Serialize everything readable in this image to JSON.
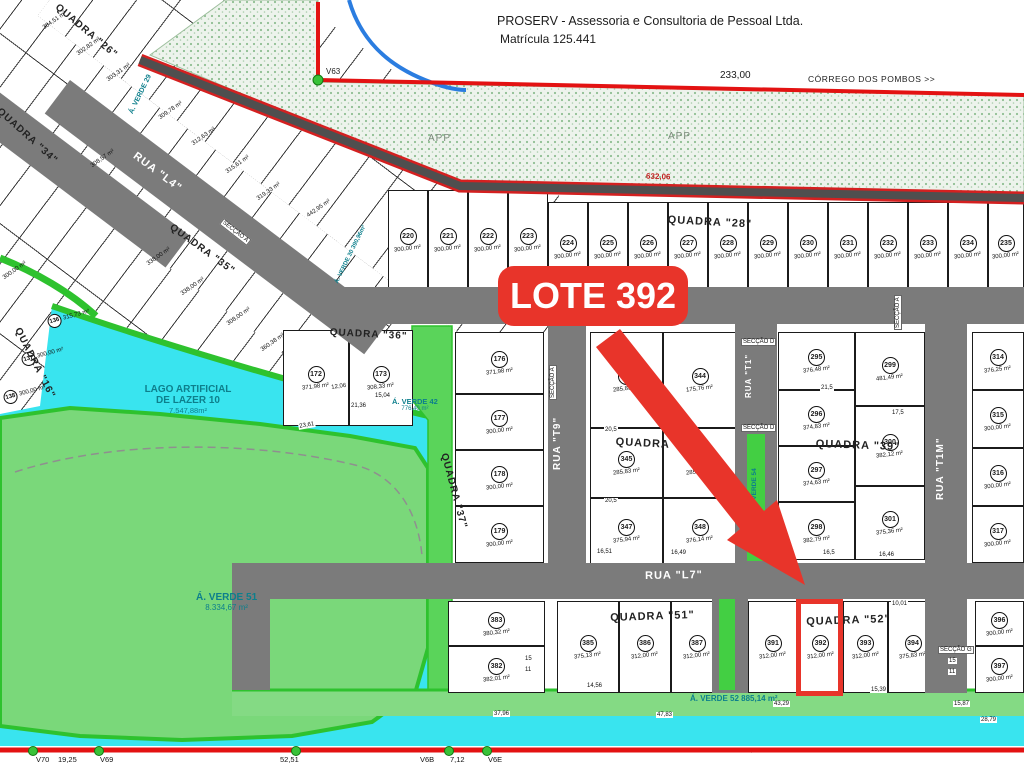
{
  "header": {
    "company_line1": "PROSERV - Assessoria e Consultoria de Pessoal Ltda.",
    "company_line2": "Matrícula 125.441",
    "dim_top": "233,00",
    "stream_label": "CÓRREGO DOS POMBOS >>",
    "vertex_label": "V63",
    "road_dim": "632,06",
    "app_label_left": "APP",
    "app_label_right": "APP"
  },
  "highlight": {
    "badge": "LOTE 392"
  },
  "colors": {
    "water": "#39e4ef",
    "green_area": "#7ad87a",
    "green_strip": "#43cf43",
    "street": "#7b7b7b",
    "boundary_red": "#e31212",
    "highlight_red": "#e8342a",
    "teal_text": "#0d7f8c"
  },
  "lake": {
    "line1": "LAGO ARTIFICIAL",
    "line2": "DE LAZER 10",
    "area": "7.547,88m²"
  },
  "greens": [
    {
      "text": "Á. VERDE 51",
      "sub": "8.334,67 m²",
      "x": 196,
      "y": 592,
      "r": 0,
      "size": 10
    },
    {
      "text": "Á. VERDE 42",
      "sub": "776,40 m²",
      "x": 392,
      "y": 397,
      "r": 0,
      "size": 7.5
    },
    {
      "text": "Á. VERDE 52   885,14 m²",
      "sub": "",
      "x": 690,
      "y": 694,
      "r": 0,
      "size": 8
    },
    {
      "text": "Á. VERDE 54",
      "sub": "",
      "x": 751,
      "y": 508,
      "r": -90,
      "size": 6.5
    },
    {
      "text": "Á. VERDE 29",
      "sub": "",
      "x": 128,
      "y": 112,
      "r": -64,
      "size": 7
    },
    {
      "text": "Á. VERDE 30 390,96m²",
      "sub": "",
      "x": 334,
      "y": 282,
      "r": -64,
      "size": 6
    }
  ],
  "ruas": [
    {
      "label": "RUA \"L4\"",
      "x": 138,
      "y": 150,
      "r": 37,
      "size": 11
    },
    {
      "label": "RUA \"L4\"",
      "x": 618,
      "y": 294,
      "r": 0,
      "size": 11
    },
    {
      "label": "RUA \"L7\"",
      "x": 645,
      "y": 570,
      "r": -1,
      "size": 11
    },
    {
      "label": "RUA \"T9\"",
      "x": 552,
      "y": 470,
      "r": -90,
      "size": 10
    },
    {
      "label": "RUA \"T1\"",
      "x": 744,
      "y": 398,
      "r": -90,
      "size": 8
    },
    {
      "label": "RUA \"T1M\"",
      "x": 935,
      "y": 500,
      "r": -90,
      "size": 10
    }
  ],
  "quadras": [
    {
      "label": "QUADRA \"26\"",
      "x": 60,
      "y": 2,
      "r": 40,
      "size": 10
    },
    {
      "label": "QUADRA \"34\"",
      "x": 2,
      "y": 106,
      "r": 42,
      "size": 10
    },
    {
      "label": "QUADRA \"16\"",
      "x": 22,
      "y": 326,
      "r": 63,
      "size": 10
    },
    {
      "label": "QUADRA \"35\"",
      "x": 174,
      "y": 222,
      "r": 36,
      "size": 10
    },
    {
      "label": "QUADRA \"36\"",
      "x": 330,
      "y": 327,
      "r": 3,
      "size": 10
    },
    {
      "label": "QUADRA \"37\"",
      "x": 449,
      "y": 452,
      "r": 75,
      "size": 10
    },
    {
      "label": "QUADRA \"28\"",
      "x": 668,
      "y": 214,
      "r": 3,
      "size": 11
    },
    {
      "label": "QUADRA",
      "x": 616,
      "y": 436,
      "r": 3,
      "size": 11
    },
    {
      "label": "QUADRA \"39\"",
      "x": 816,
      "y": 438,
      "r": 2,
      "size": 11
    },
    {
      "label": "QUADRA \"51\"",
      "x": 610,
      "y": 612,
      "r": -2,
      "size": 11
    },
    {
      "label": "QUADRA \"52\"",
      "x": 806,
      "y": 616,
      "r": -2,
      "size": 11
    }
  ],
  "lots": [
    {
      "n": 220,
      "a": "300,00 m²",
      "x": 388,
      "y": 190,
      "w": 40,
      "h": 100
    },
    {
      "n": 221,
      "a": "300,00 m²",
      "x": 428,
      "y": 190,
      "w": 40,
      "h": 100
    },
    {
      "n": 222,
      "a": "300,00 m²",
      "x": 468,
      "y": 190,
      "w": 40,
      "h": 100
    },
    {
      "n": 223,
      "a": "300,00 m²",
      "x": 508,
      "y": 190,
      "w": 40,
      "h": 100
    },
    {
      "n": 224,
      "a": "300,00 m²",
      "x": 548,
      "y": 202,
      "w": 40,
      "h": 89
    },
    {
      "n": 225,
      "a": "300,00 m²",
      "x": 588,
      "y": 202,
      "w": 40,
      "h": 89
    },
    {
      "n": 226,
      "a": "300,00 m²",
      "x": 628,
      "y": 202,
      "w": 40,
      "h": 89
    },
    {
      "n": 227,
      "a": "300,00 m²",
      "x": 668,
      "y": 202,
      "w": 40,
      "h": 89
    },
    {
      "n": 228,
      "a": "300,00 m²",
      "x": 708,
      "y": 202,
      "w": 40,
      "h": 89
    },
    {
      "n": 229,
      "a": "300,00 m²",
      "x": 748,
      "y": 202,
      "w": 40,
      "h": 89
    },
    {
      "n": 230,
      "a": "300,00 m²",
      "x": 788,
      "y": 202,
      "w": 40,
      "h": 89
    },
    {
      "n": 231,
      "a": "300,00 m²",
      "x": 828,
      "y": 202,
      "w": 40,
      "h": 89
    },
    {
      "n": 232,
      "a": "300,00 m²",
      "x": 868,
      "y": 202,
      "w": 40,
      "h": 89
    },
    {
      "n": 233,
      "a": "300,00 m²",
      "x": 908,
      "y": 202,
      "w": 40,
      "h": 89
    },
    {
      "n": 234,
      "a": "300,00 m²",
      "x": 948,
      "y": 202,
      "w": 40,
      "h": 89
    },
    {
      "n": 235,
      "a": "300,00 m²",
      "x": 988,
      "y": 202,
      "w": 36,
      "h": 89
    },
    {
      "n": 172,
      "a": "371,98 m²",
      "x": 283,
      "y": 330,
      "w": 66,
      "h": 96
    },
    {
      "n": 173,
      "a": "308,33 m²",
      "x": 349,
      "y": 330,
      "w": 64,
      "h": 96
    },
    {
      "n": 176,
      "a": "371,98 m²",
      "x": 455,
      "y": 332,
      "w": 89,
      "h": 62
    },
    {
      "n": 177,
      "a": "300,00 m²",
      "x": 455,
      "y": 394,
      "w": 89,
      "h": 56
    },
    {
      "n": 178,
      "a": "300,00 m²",
      "x": 455,
      "y": 450,
      "w": 89,
      "h": 56
    },
    {
      "n": 179,
      "a": "300,00 m²",
      "x": 455,
      "y": 506,
      "w": 89,
      "h": 57
    },
    {
      "n": 343,
      "a": "285,83 m²",
      "x": 590,
      "y": 332,
      "w": 73,
      "h": 96
    },
    {
      "n": 344,
      "a": "175,76 m²",
      "x": 663,
      "y": 332,
      "w": 74,
      "h": 96
    },
    {
      "n": 345,
      "a": "285,83 m²",
      "x": 590,
      "y": 428,
      "w": 73,
      "h": 70
    },
    {
      "n": 346,
      "a": "285,83 m²",
      "x": 663,
      "y": 428,
      "w": 74,
      "h": 70
    },
    {
      "n": 347,
      "a": "375,94 m²",
      "x": 590,
      "y": 498,
      "w": 73,
      "h": 66
    },
    {
      "n": 348,
      "a": "376,14 m²",
      "x": 663,
      "y": 498,
      "w": 74,
      "h": 66
    },
    {
      "n": 295,
      "a": "376,48 m²",
      "x": 778,
      "y": 332,
      "w": 77,
      "h": 58
    },
    {
      "n": 296,
      "a": "374,83 m²",
      "x": 778,
      "y": 390,
      "w": 77,
      "h": 56
    },
    {
      "n": 297,
      "a": "374,63 m²",
      "x": 778,
      "y": 446,
      "w": 77,
      "h": 56
    },
    {
      "n": 298,
      "a": "382,79 m²",
      "x": 778,
      "y": 502,
      "w": 77,
      "h": 58
    },
    {
      "n": 299,
      "a": "481,49 m²",
      "x": 855,
      "y": 332,
      "w": 70,
      "h": 74
    },
    {
      "n": 300,
      "a": "382,12 m²",
      "x": 855,
      "y": 406,
      "w": 70,
      "h": 80
    },
    {
      "n": 301,
      "a": "375,36 m²",
      "x": 855,
      "y": 486,
      "w": 70,
      "h": 74
    },
    {
      "n": 314,
      "a": "376,25 m²",
      "x": 972,
      "y": 332,
      "w": 52,
      "h": 58
    },
    {
      "n": 315,
      "a": "300,00 m²",
      "x": 972,
      "y": 390,
      "w": 52,
      "h": 58
    },
    {
      "n": 316,
      "a": "300,00 m²",
      "x": 972,
      "y": 448,
      "w": 52,
      "h": 58
    },
    {
      "n": 317,
      "a": "300,00 m²",
      "x": 972,
      "y": 506,
      "w": 52,
      "h": 57
    },
    {
      "n": 383,
      "a": "380,32 m²",
      "x": 448,
      "y": 601,
      "w": 97,
      "h": 45
    },
    {
      "n": 382,
      "a": "382,01 m²",
      "x": 448,
      "y": 646,
      "w": 97,
      "h": 47
    },
    {
      "n": 385,
      "a": "375,13 m²",
      "x": 557,
      "y": 601,
      "w": 62,
      "h": 92
    },
    {
      "n": 386,
      "a": "312,00 m²",
      "x": 619,
      "y": 601,
      "w": 52,
      "h": 92
    },
    {
      "n": 387,
      "a": "312,00 m²",
      "x": 671,
      "y": 601,
      "w": 52,
      "h": 92
    },
    {
      "n": 391,
      "a": "312,00 m²",
      "x": 748,
      "y": 601,
      "w": 50,
      "h": 92
    },
    {
      "n": 392,
      "a": "312,00 m²",
      "x": 798,
      "y": 601,
      "w": 45,
      "h": 92
    },
    {
      "n": 393,
      "a": "312,00 m²",
      "x": 843,
      "y": 601,
      "w": 45,
      "h": 92
    },
    {
      "n": 394,
      "a": "375,83 m²",
      "x": 888,
      "y": 601,
      "w": 50,
      "h": 92
    },
    {
      "n": 396,
      "a": "300,00 m²",
      "x": 975,
      "y": 601,
      "w": 49,
      "h": 45
    },
    {
      "n": 397,
      "a": "300,00 m²",
      "x": 975,
      "y": 646,
      "w": 49,
      "h": 47
    }
  ],
  "diag": [
    {
      "t": "304,51 m²",
      "x": 42,
      "y": 26,
      "r": -35
    },
    {
      "t": "302,82 m²",
      "x": 76,
      "y": 52,
      "r": -35
    },
    {
      "t": "303,31 m²",
      "x": 106,
      "y": 78,
      "r": -35
    },
    {
      "t": "309,78 m²",
      "x": 158,
      "y": 116,
      "r": -35
    },
    {
      "t": "312,63 m²",
      "x": 191,
      "y": 142,
      "r": -35
    },
    {
      "t": "315,61 m²",
      "x": 225,
      "y": 170,
      "r": -35
    },
    {
      "t": "319,33 m²",
      "x": 256,
      "y": 197,
      "r": -35
    },
    {
      "t": "442,95 m²",
      "x": 306,
      "y": 214,
      "r": -35
    },
    {
      "t": "308,57 m²",
      "x": 90,
      "y": 164,
      "r": -35
    },
    {
      "t": "300,00 m²",
      "x": 2,
      "y": 276,
      "r": -35
    },
    {
      "t": "338,00 m²",
      "x": 146,
      "y": 262,
      "r": -35
    },
    {
      "t": "338,00 m²",
      "x": 180,
      "y": 292,
      "r": -35
    },
    {
      "t": "308,00 m²",
      "x": 226,
      "y": 322,
      "r": -35
    },
    {
      "t": "360,38 m²",
      "x": 260,
      "y": 348,
      "r": -35
    },
    {
      "n": 136,
      "t": "315,73 m²",
      "x": 46,
      "y": 316,
      "r": -15
    },
    {
      "n": 137,
      "t": "300,00 m²",
      "x": 20,
      "y": 354,
      "r": -15
    },
    {
      "n": 138,
      "t": "300,00 m²",
      "x": 2,
      "y": 392,
      "r": -15
    }
  ],
  "chips": [
    {
      "t": "23,61",
      "x": 298,
      "y": 424,
      "r": -10
    },
    {
      "t": "21,36",
      "x": 350,
      "y": 403,
      "r": 0
    },
    {
      "t": "15,04",
      "x": 374,
      "y": 393,
      "r": 0
    },
    {
      "t": "12,06",
      "x": 330,
      "y": 385,
      "r": -8
    },
    {
      "t": "20,5",
      "x": 604,
      "y": 427,
      "r": 0
    },
    {
      "t": "20,5",
      "x": 604,
      "y": 498,
      "r": 0
    },
    {
      "t": "21,5",
      "x": 820,
      "y": 385,
      "r": 0
    },
    {
      "t": "17,5",
      "x": 891,
      "y": 410,
      "r": 0
    },
    {
      "t": "16,51",
      "x": 596,
      "y": 549,
      "r": 0
    },
    {
      "t": "16,49",
      "x": 670,
      "y": 550,
      "r": 0
    },
    {
      "t": "16,5",
      "x": 822,
      "y": 550,
      "r": 0
    },
    {
      "t": "16,46",
      "x": 878,
      "y": 552,
      "r": 0
    },
    {
      "t": "14,56",
      "x": 586,
      "y": 683,
      "r": 0
    },
    {
      "t": "15,39",
      "x": 870,
      "y": 687,
      "r": 0
    },
    {
      "t": "10,01",
      "x": 891,
      "y": 601,
      "r": 0
    },
    {
      "t": "37,96",
      "x": 493,
      "y": 711,
      "r": 0
    },
    {
      "t": "47,83",
      "x": 656,
      "y": 712,
      "r": 0
    },
    {
      "t": "43,29",
      "x": 773,
      "y": 701,
      "r": 0
    },
    {
      "t": "15,87",
      "x": 953,
      "y": 701,
      "r": 0
    },
    {
      "t": "28,79",
      "x": 980,
      "y": 717,
      "r": 0
    },
    {
      "t": "181,16",
      "x": 740,
      "y": 748,
      "r": 0
    },
    {
      "t": "15",
      "x": 948,
      "y": 658,
      "r": 0
    },
    {
      "t": "11",
      "x": 948,
      "y": 669,
      "r": 0
    },
    {
      "t": "15",
      "x": 524,
      "y": 656,
      "r": 0
    },
    {
      "t": "11",
      "x": 524,
      "y": 667,
      "r": 0
    }
  ],
  "seccao": [
    {
      "t": "SECÇÃO A",
      "x": 224,
      "y": 218,
      "r": 38
    },
    {
      "t": "SECÇÃO A",
      "x": 549,
      "y": 400,
      "r": -90
    },
    {
      "t": "SECÇÃO A",
      "x": 894,
      "y": 330,
      "r": -90
    },
    {
      "t": "SECÇÃO D",
      "x": 741,
      "y": 338,
      "r": 0
    },
    {
      "t": "SECÇÃO D",
      "x": 741,
      "y": 424,
      "r": 0
    },
    {
      "t": "SECÇÃO G",
      "x": 938,
      "y": 646,
      "r": 0
    }
  ],
  "bottom": {
    "labels": [
      {
        "t": "V70",
        "x": 36
      },
      {
        "t": "19,25",
        "x": 58
      },
      {
        "t": "V69",
        "x": 100
      },
      {
        "t": "52,51",
        "x": 280
      },
      {
        "t": "V6B",
        "x": 420
      },
      {
        "t": "7,12",
        "x": 450
      },
      {
        "t": "V6E",
        "x": 488
      }
    ],
    "dots_x": [
      32,
      98,
      295,
      448,
      486
    ]
  }
}
